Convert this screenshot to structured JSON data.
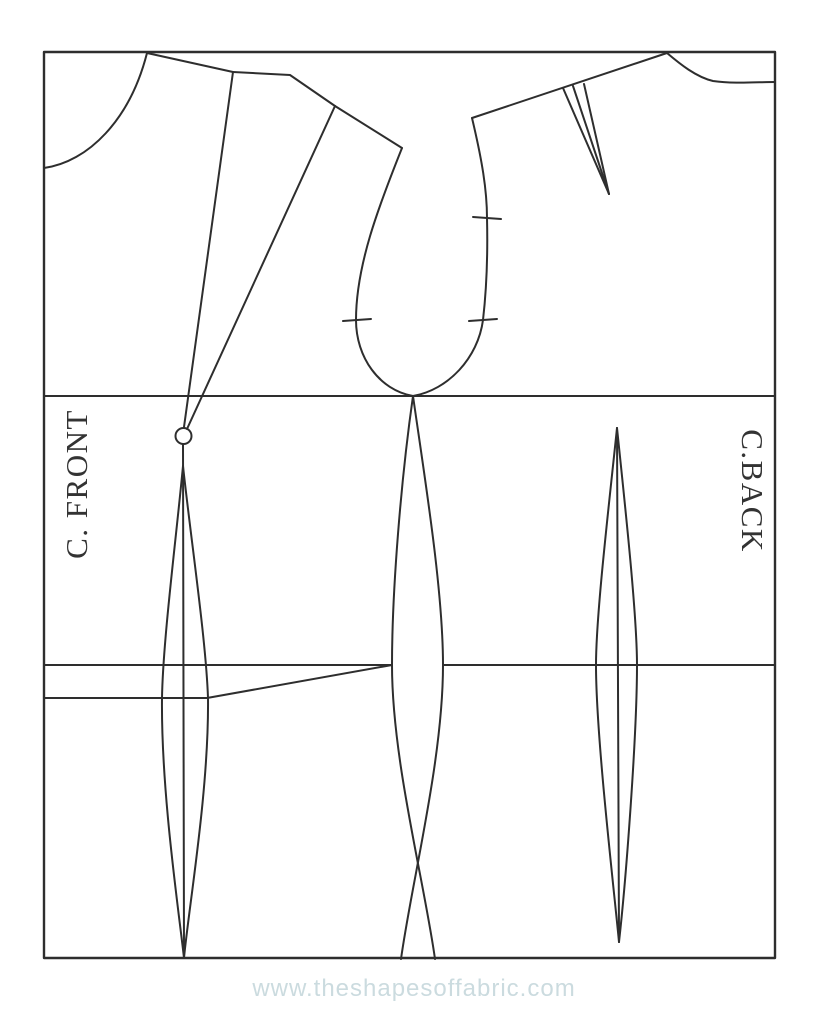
{
  "diagram": {
    "labels": {
      "front": "C. FRONT",
      "back": "C.BACK"
    },
    "watermark": {
      "text": "www.theshapesoffabric.com",
      "color": "#cbdbdf"
    },
    "colors": {
      "line": "#2e2e2e",
      "label": "#333333",
      "background": "#ffffff"
    }
  }
}
